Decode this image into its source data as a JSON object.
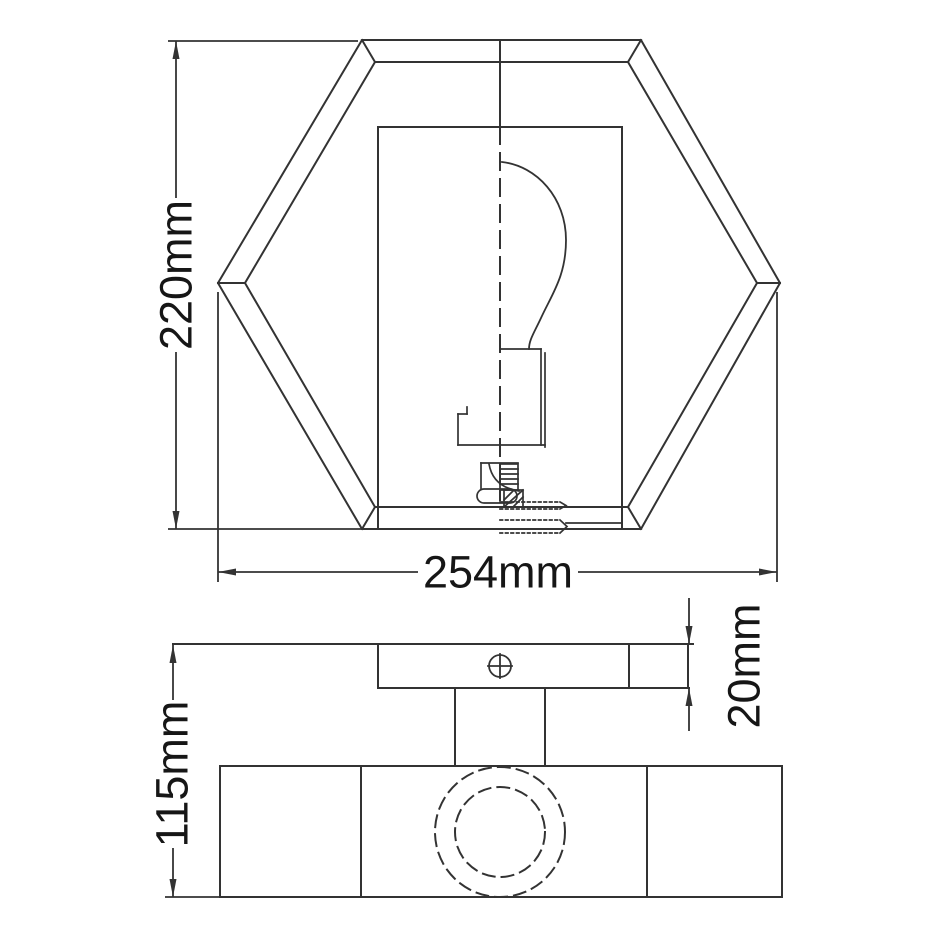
{
  "dimensions": {
    "front_height": "220mm",
    "front_width": "254mm",
    "side_height": "115mm",
    "plate_thickness": "20mm"
  },
  "icons": {
    "screw_icon": "circle-with-cross"
  },
  "colors": {
    "background": "#ffffff",
    "line": "#333333",
    "text": "#161616"
  }
}
